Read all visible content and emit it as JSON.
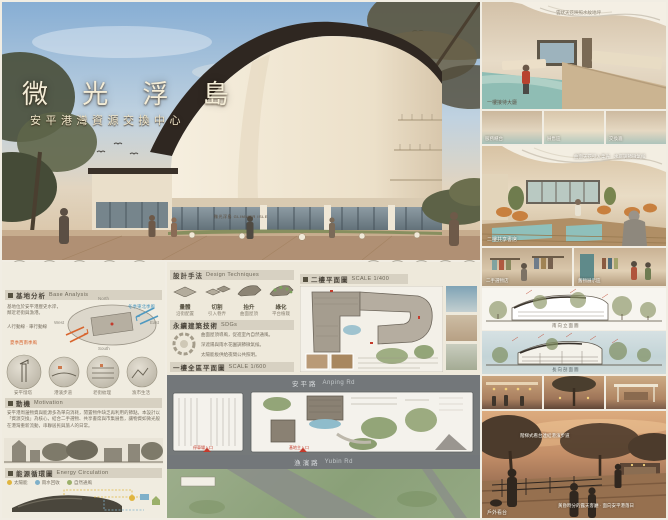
{
  "poster": {
    "title": "微 光 浮 島",
    "subtitle": "安平港灣資源交換中心",
    "sign": "微光浮島 GLIMMER ISLE"
  },
  "hero": {
    "icons_left": [
      {
        "glyph": "♻",
        "label": "資源回收"
      },
      {
        "glyph": "✳",
        "label": "物品交換"
      },
      {
        "glyph": "⌂",
        "label": "社區共享"
      },
      {
        "glyph": "☁",
        "label": "雨水利用"
      },
      {
        "glyph": "▦",
        "label": "市集展售"
      }
    ],
    "icons_right": [
      {
        "glyph": "✦"
      },
      {
        "glyph": "❋"
      },
      {
        "glyph": "⌂"
      },
      {
        "glyph": "☀"
      },
      {
        "glyph": "◍"
      }
    ]
  },
  "left_panel": {
    "base": {
      "zh": "基地分析",
      "en": "Base Analysis",
      "note1": "基地位於安平港歷史水岸，鄰近老街與漁港。",
      "note2": "人行動線 · 車行動線",
      "wind_ne": "冬季東北季風",
      "wind_sw": "夏季西南季風",
      "compass": [
        "North",
        "West",
        "East",
        "South"
      ],
      "vignettes": [
        "安平燈塔",
        "港濱步道",
        "老街紋理",
        "漁市生活"
      ]
    },
    "motivation": {
      "zh": "動機",
      "en": "Motivation",
      "body": "安平港周邊物資與能源多為單向消耗，閒置物件缺乏再利用的節點。本設計以「資源交換」為核心，結合二手選物、共享書席與市集展售，讓物資如微光般在港灣重新流動，串聯居民與旅人的日常。"
    },
    "energy": {
      "zh": "能源循環圖",
      "en": "Energy Circulation",
      "legend": [
        {
          "label": "太陽能"
        },
        {
          "label": "雨水回收"
        },
        {
          "label": "自然通風"
        }
      ]
    }
  },
  "middle": {
    "design": {
      "zh": "設計手法",
      "en": "Design Techniques",
      "steps": [
        {
          "label": "量體",
          "note": "沿街配置"
        },
        {
          "label": "切割",
          "note": "引入巷弄"
        },
        {
          "label": "抬升",
          "note": "曲面屋頂"
        },
        {
          "label": "綠化",
          "note": "平台植栽"
        }
      ]
    },
    "sdgs": {
      "zh": "永續建築技術",
      "en": "SDGs",
      "line1": "曲面屋頂導風，促進室內自然通風。",
      "line2": "深遮陽與雨水花園調節微氣候。",
      "line3": "太陽能板供給夜間公共照明。"
    },
    "plan1f": {
      "zh": "一樓全區平面圖",
      "scale": "SCALE 1/600"
    },
    "plan2f": {
      "zh": "二樓平面圖",
      "scale": "SCALE 1/400"
    },
    "roads": {
      "top_zh": "安平路",
      "top_en": "Anping Rd",
      "bottom_zh": "漁濱路",
      "bottom_en": "Yubin Rd"
    },
    "entries": {
      "parking": "停車場入口",
      "main": "基地主入口"
    }
  },
  "right": {
    "r1": {
      "caption": "一樓接待大廳",
      "note": "雲狀天花映照水紋地坪"
    },
    "thumbs1": [
      "服務櫃台",
      "展售區",
      "交換牆"
    ],
    "r2": {
      "caption": "二樓共享書席",
      "note": "曲面天花引入柔光 · 水庭調節微氣候"
    },
    "thumbs2": [
      "二手選物店",
      "舊物展示區"
    ],
    "elev": {
      "caption": "南向立面圖"
    },
    "sect": {
      "caption": "長向剖面圖"
    },
    "r3": {
      "caption": "戶外看台",
      "note1": "階梯式看台連結港濱步道",
      "note2": "黃昏時分的露天客廳 · 面向安平港落日"
    }
  }
}
